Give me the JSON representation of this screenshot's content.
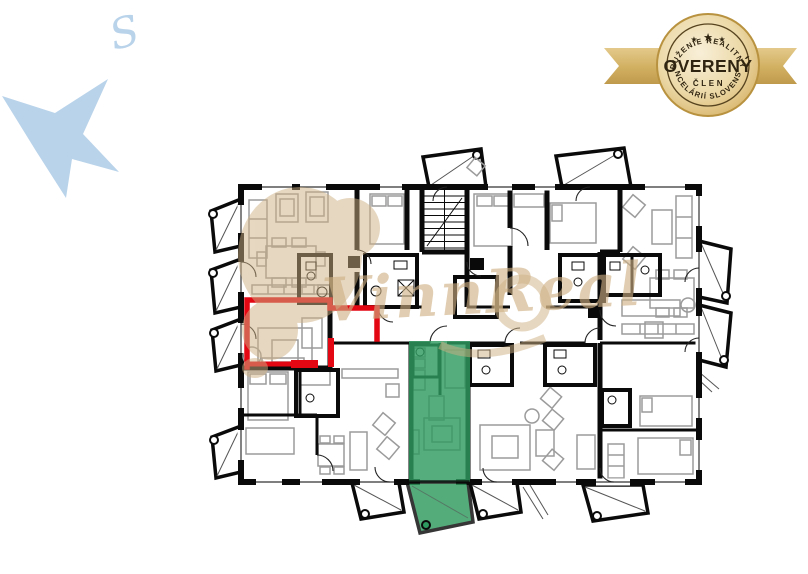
{
  "page": {
    "background": "#ffffff",
    "description": "Real-estate floor plan of a multi-unit residential floor with one unit outlined in red and one unit highlighted in green"
  },
  "compass": {
    "direction_label": "S",
    "star_color": "#b9d3ea",
    "label_color": "#c3d8ee",
    "icon": "compass-star"
  },
  "certification_badge": {
    "arc_top_text": "ZDRUŽENIE REALITNÝCH",
    "title": "OVERENÝ",
    "subtitle": "ČLEN",
    "arc_bottom_text": "KANCELÁRIÍ SLOVENSKA",
    "star_icon": "★",
    "colors": {
      "gold_light": "#f8efd8",
      "gold": "#d9b967",
      "gold_dark": "#b8923f",
      "ribbon": "#d3b264",
      "text": "#2f2410"
    }
  },
  "floor_plan": {
    "kind": "multi-unit residential floor plan",
    "wall_color": "#0a0a0a",
    "furniture_color": "#9b9b9b",
    "highlighted_units": [
      {
        "id": "red-outline-unit",
        "style": "outline",
        "color": "#e30613"
      },
      {
        "id": "green-selected-unit",
        "style": "fill",
        "color": "#2f9a5f"
      }
    ]
  },
  "watermark": {
    "text": "VinnReal",
    "color": "#cfb184"
  }
}
